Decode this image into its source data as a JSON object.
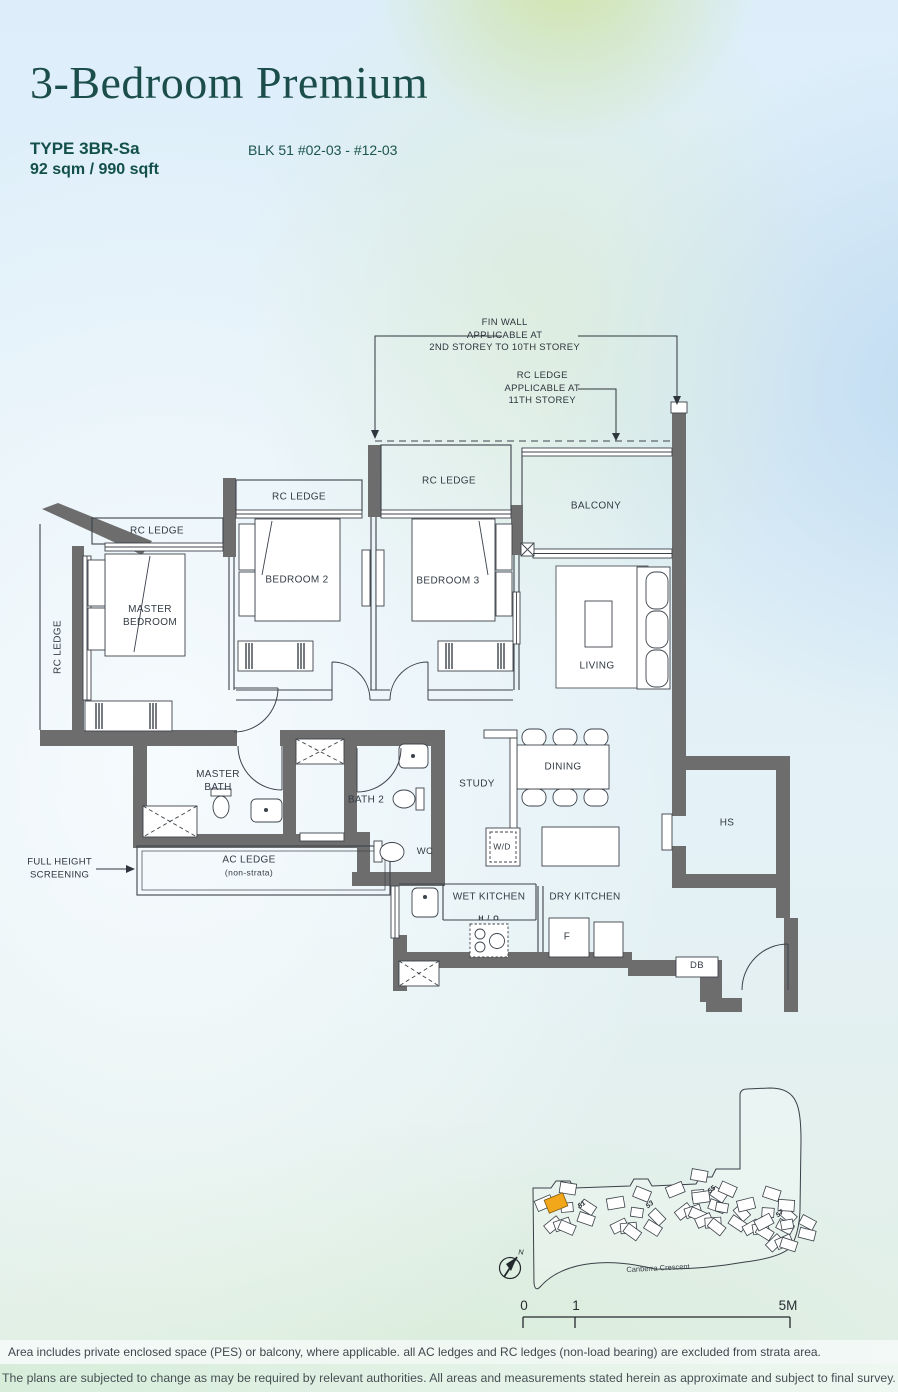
{
  "header": {
    "title": "3-Bedroom Premium",
    "type_label": "TYPE 3BR-Sa",
    "area": "92 sqm / 990 sqft",
    "block_range": "BLK 51 #02-03 - #12-03"
  },
  "annotations": {
    "fin_wall": "FIN WALL\nAPPLICABLE AT\n2ND STOREY TO 10TH STOREY",
    "rc_ledge_11": "RC LEDGE\nAPPLICABLE AT\n11TH STOREY",
    "full_height_screening": "FULL HEIGHT\nSCREENING"
  },
  "rooms": {
    "rc_ledge": "RC LEDGE",
    "master_bedroom": "MASTER\nBEDROOM",
    "bedroom2": "BEDROOM 2",
    "bedroom3": "BEDROOM 3",
    "balcony": "BALCONY",
    "living": "LIVING",
    "dining": "DINING",
    "study": "STUDY",
    "master_bath": "MASTER\nBATH",
    "bath2": "BATH 2",
    "wc": "WC",
    "ac_ledge": "AC LEDGE",
    "ac_ledge_sub": "(non-strata)",
    "hs": "HS",
    "wet_kitchen": "WET KITCHEN",
    "dry_kitchen": "DRY KITCHEN",
    "wd": "W/D",
    "fridge": "F",
    "db": "DB",
    "ho": "H / O"
  },
  "site_map": {
    "street": "Canberra Crescent",
    "north": "N",
    "blocks": [
      "51",
      "53",
      "55",
      "57"
    ],
    "highlight_color": "#F2A71B"
  },
  "scale_bar": {
    "start": "0",
    "mid": "1",
    "end": "5M"
  },
  "footer": {
    "line1": "Area includes private enclosed space (PES) or balcony, where applicable. all AC ledges and RC ledges (non-load bearing) are excluded from strata area.",
    "line2": "The plans are subjected to change as may be required by relevant authorities. All areas and measurements stated herein as approximate and subject to final survey."
  },
  "colors": {
    "title": "#1B4E4A",
    "wall": "#6D6D6D",
    "label": "#333B44",
    "highlight": "#F2A71B"
  }
}
